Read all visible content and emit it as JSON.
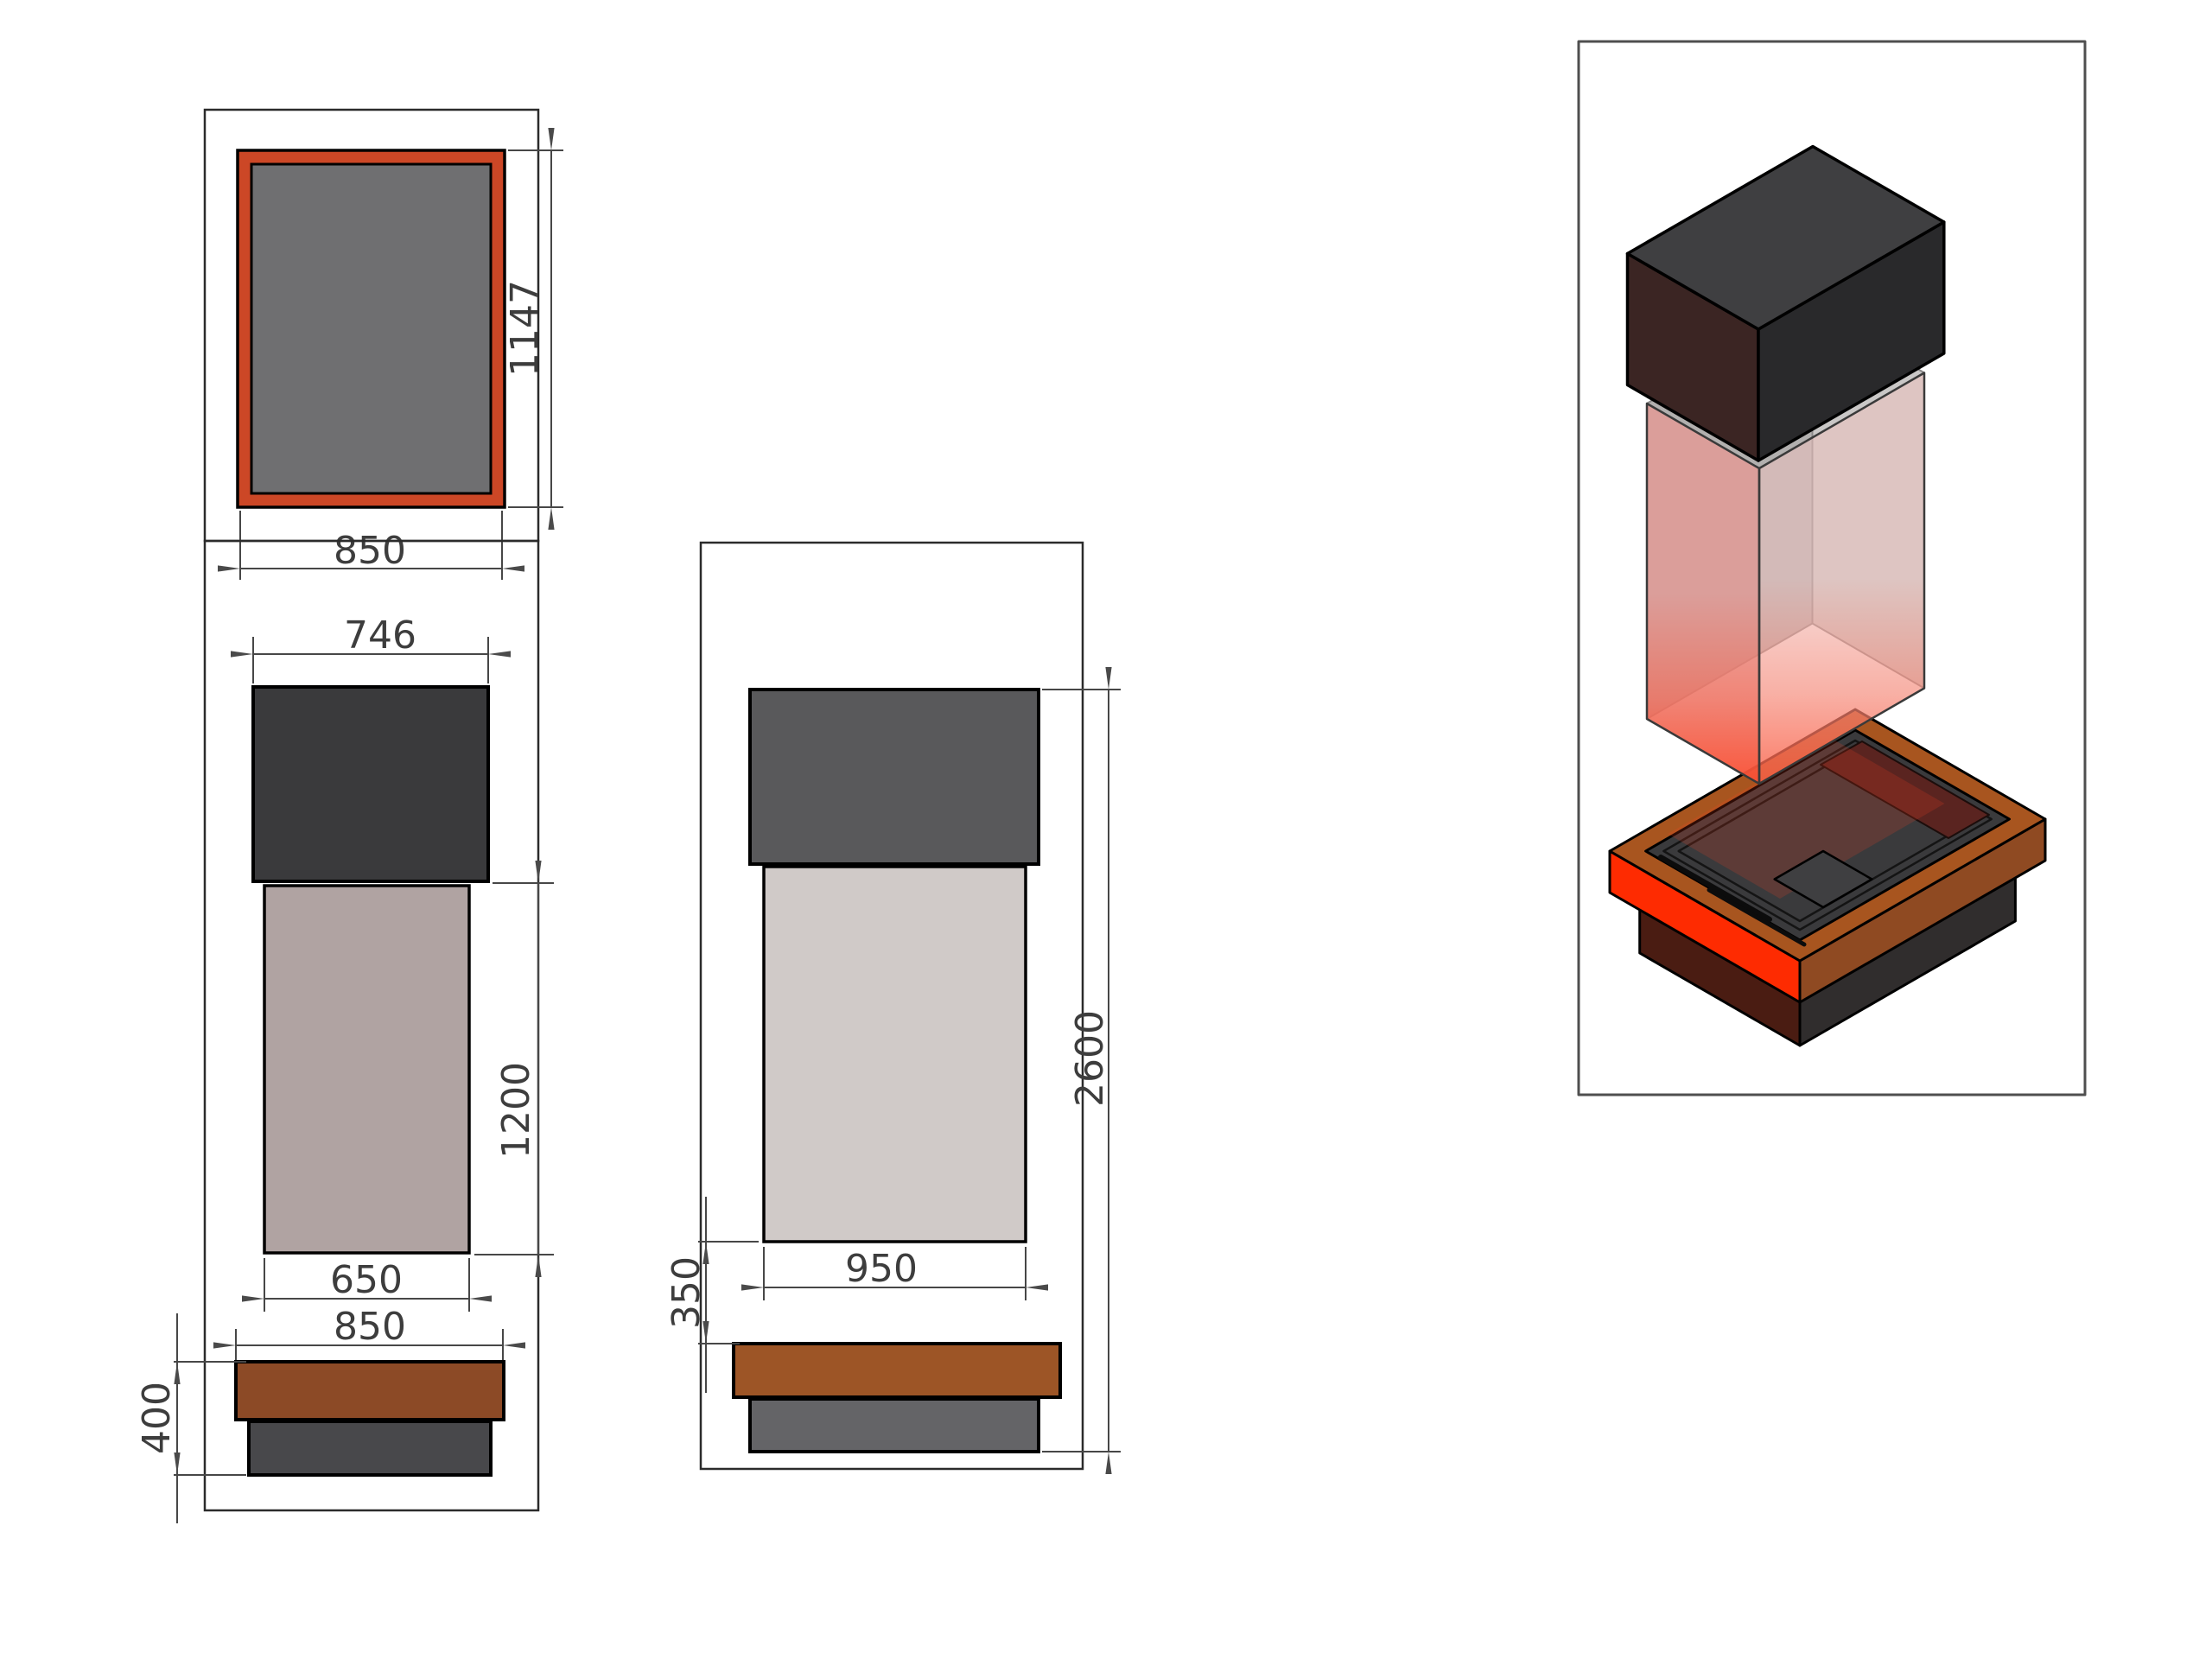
{
  "drawing": {
    "kind": "fireplace technical drawing, three orthographic views and one isometric exploded view",
    "views": {
      "top": {
        "label": "top-view",
        "dims": {
          "depth": "1147",
          "width": "850"
        }
      },
      "front": {
        "label": "front-view",
        "dims": {
          "hood_width": "746",
          "body_height": "1200",
          "body_width": "650",
          "base_width": "850",
          "base_height": "400"
        }
      },
      "side": {
        "label": "side-view",
        "dims": {
          "body_width": "950",
          "opening_height": "350",
          "total_height": "2600"
        }
      },
      "iso": {
        "label": "isometric-view"
      }
    }
  },
  "colors": {
    "dim_line": "#474747",
    "frame_line": "#2b2b2b",
    "plate_orange": "#cc4726",
    "plate_gray": "#6f6f71",
    "front_hood": "#3a3a3c",
    "front_body": "#b0a3a2",
    "front_bar": "#8c4a26",
    "front_base": "#48484b",
    "side_hood": "#59595b",
    "side_body": "#d0cac8",
    "side_bar": "#9d5526",
    "side_base": "#646467",
    "iso_hood_top": "#3f3f41",
    "iso_hood_left": "#3b2523",
    "iso_hood_right": "#29292b",
    "glass_pink": "#e49a95",
    "glass_pink_light": "#eec3bf",
    "interior_wall": "#b2b0af",
    "interior_wall_light": "#c9c7c6",
    "glass_top": "#d8d6d5",
    "rim_rust": "#a8551f",
    "band_red": "#fe2b01",
    "band_rust": "#8f4a22",
    "plinth_maroon": "#4a1c12",
    "plinth_dark": "#302d2d",
    "tray_dark": "#3a3a3c",
    "patch_maroon": "#5a2420",
    "glow_red": "#ff3a18"
  }
}
